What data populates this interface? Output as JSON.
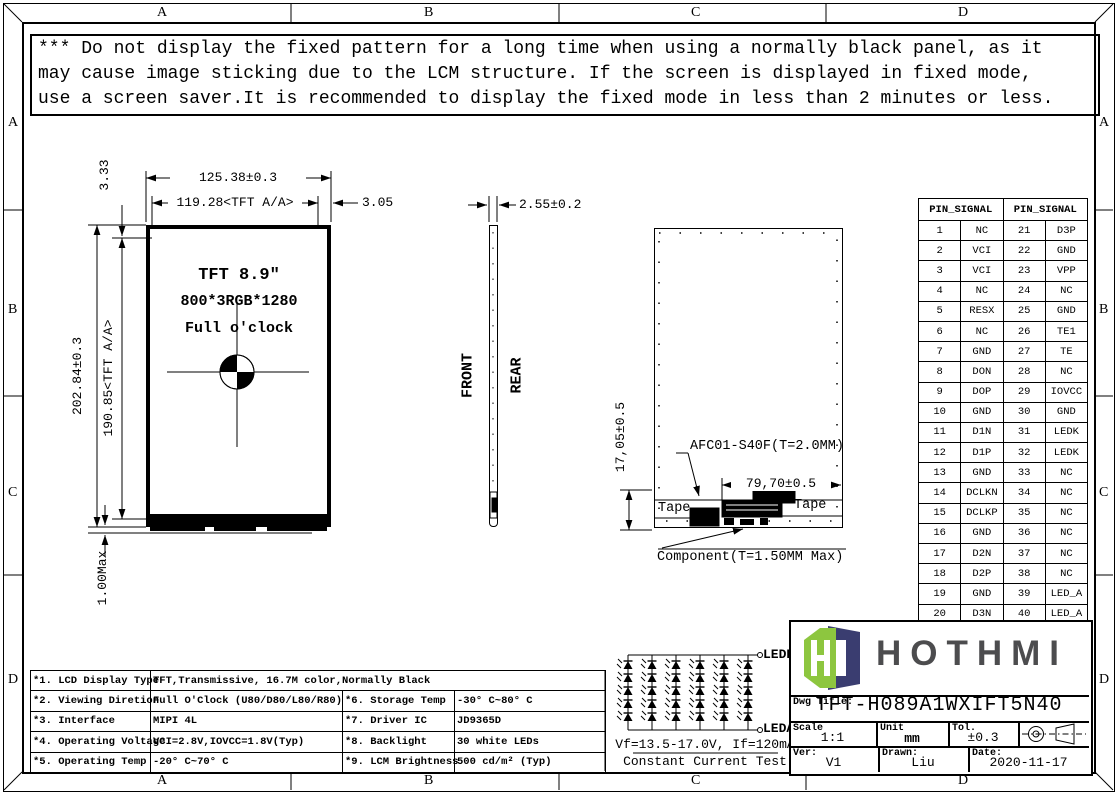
{
  "sheet": {
    "grid": {
      "top": [
        "A",
        "B",
        "C",
        "D"
      ],
      "bottom": [
        "A",
        "B",
        "C",
        "D"
      ],
      "left": [
        "A",
        "B",
        "C",
        "D"
      ],
      "right": [
        "A",
        "B",
        "C",
        "D"
      ]
    },
    "warning": {
      "line1": "*** Do not display the fixed pattern for a long time when using a normally black panel, as it",
      "line2": " may cause image sticking due to the LCM structure. If the screen is displayed in fixed mode,",
      "line3": " use a screen saver.It is recommended to display the fixed mode in less than 2 minutes or less."
    }
  },
  "front_view": {
    "display_line1": "TFT 8.9″",
    "display_line2": "800*3RGB*1280",
    "display_line3": "Full o'clock",
    "dim_overall_width": "125.38±0.3",
    "dim_aa_width": "119.28<TFT A/A>",
    "dim_right_margin": "3.05",
    "dim_top_margin": "3.33",
    "dim_overall_height": "202.84±0.3",
    "dim_aa_height": "190.85<TFT A/A>",
    "dim_bottom": "1.00Max"
  },
  "side_view": {
    "dim_thickness": "2.55±0.2",
    "front_label": "FRONT",
    "rear_label": "REAR"
  },
  "rear_view": {
    "dim_height": "17,05±0.5",
    "connector_label": "AFC01-S40F(T=2.0MM)",
    "dim_width": "79,70±0.5",
    "tape_left": "Tape",
    "tape_right": "Tape",
    "component_label": "Component(T=1.50MM Max)"
  },
  "pin_table": {
    "header_left": "PIN_SIGNAL",
    "header_right": "PIN_SIGNAL",
    "rows": [
      [
        "1",
        "NC",
        "21",
        "D3P"
      ],
      [
        "2",
        "VCI",
        "22",
        "GND"
      ],
      [
        "3",
        "VCI",
        "23",
        "VPP"
      ],
      [
        "4",
        "NC",
        "24",
        "NC"
      ],
      [
        "5",
        "RESX",
        "25",
        "GND"
      ],
      [
        "6",
        "NC",
        "26",
        "TE1"
      ],
      [
        "7",
        "GND",
        "27",
        "TE"
      ],
      [
        "8",
        "DON",
        "28",
        "NC"
      ],
      [
        "9",
        "DOP",
        "29",
        "IOVCC"
      ],
      [
        "10",
        "GND",
        "30",
        "GND"
      ],
      [
        "11",
        "D1N",
        "31",
        "LEDK"
      ],
      [
        "12",
        "D1P",
        "32",
        "LEDK"
      ],
      [
        "13",
        "GND",
        "33",
        "NC"
      ],
      [
        "14",
        "DCLKN",
        "34",
        "NC"
      ],
      [
        "15",
        "DCLKP",
        "35",
        "NC"
      ],
      [
        "16",
        "GND",
        "36",
        "NC"
      ],
      [
        "17",
        "D2N",
        "37",
        "NC"
      ],
      [
        "18",
        "D2P",
        "38",
        "NC"
      ],
      [
        "19",
        "GND",
        "39",
        "LED_A"
      ],
      [
        "20",
        "D3N",
        "40",
        "LED_A"
      ]
    ]
  },
  "spec_table": {
    "rows": [
      {
        "cells": [
          {
            "t": "*1. LCD Display Type"
          },
          {
            "t": "TFT,Transmissive, 16.7M color,Normally Black",
            "span": 3
          }
        ]
      },
      {
        "cells": [
          {
            "t": "*2. Viewing Diretion"
          },
          {
            "t": "Full O'Clock (U80/D80/L80/R80)"
          },
          {
            "t": "*6. Storage Temp"
          },
          {
            "t": "-30° C~80° C"
          }
        ]
      },
      {
        "cells": [
          {
            "t": "*3. Interface"
          },
          {
            "t": "MIPI 4L"
          },
          {
            "t": "*7. Driver IC"
          },
          {
            "t": "JD9365D"
          }
        ]
      },
      {
        "cells": [
          {
            "t": "*4. Operating Voltage"
          },
          {
            "t": "VCI=2.8V,IOVCC=1.8V(Typ)"
          },
          {
            "t": "*8. Backlight"
          },
          {
            "t": "30 white LEDs"
          }
        ]
      },
      {
        "cells": [
          {
            "t": "*5. Operating Temp"
          },
          {
            "t": "-20° C~70° C"
          },
          {
            "t": "*9. LCM Brightness"
          },
          {
            "t": "500 cd/m² (Typ)"
          }
        ]
      }
    ]
  },
  "led_circuit": {
    "ledk_label": "LEDK",
    "leda_label": "LEDA",
    "vf_text": "Vf=13.5-17.0V, If=120mA",
    "test_text": "Constant Current Test",
    "columns": 6,
    "leds_per_column": 5
  },
  "title_block": {
    "brand": "HOTHMI",
    "logo_green": "#8dc63f",
    "logo_navy": "#3a3d70",
    "brand_color": "#4c4c4e",
    "dwg_title_label": "Dwg Title:",
    "dwg_title": "TFT-H089A1WXIFT5N40",
    "scale_label": "Scale",
    "scale_value": "1:1",
    "unit_label": "Unit",
    "unit_value": "mm",
    "tol_label": "Tol.",
    "tol_value": "±0.3",
    "ver_label": "Ver:",
    "ver_value": "V1",
    "drawn_label": "Drawn:",
    "drawn_value": "Liu",
    "date_label": "Date:",
    "date_value": "2020-11-17"
  }
}
